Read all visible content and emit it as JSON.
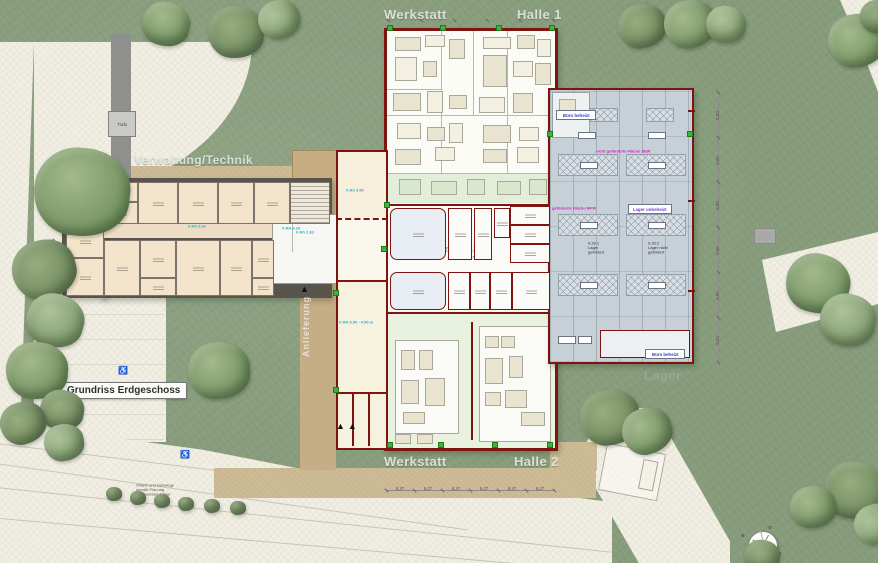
{
  "plan": {
    "title_box": "Grundriss Erdgeschoss",
    "zones": {
      "werkstatt_top": "Werkstatt",
      "halle_1": "Halle 1",
      "werkstatt_bottom": "Werkstatt",
      "halle_2": "Halle 2",
      "verwaltung": "Verwaltung/Technik",
      "sozialtrakt": "Sozialtrakt",
      "lager": "Lager",
      "anlieferung": "Anlieferung"
    },
    "funding_labels": {
      "nicht_gefoerdert": "nicht geförderte Fläche SEW",
      "gefoerdert": "geförderte Fläche MFW",
      "lager_unbeheizt": "Lager unbeheizt",
      "buero_beheizt_1": "Büro beheizt",
      "buero_beheizt_2": "Büro beheizt"
    },
    "room_notes": {
      "lager_gefoerdert": "0.28.1\nLager gefördert",
      "lager_nicht_gefoerdert": "0.28.2\nLager nicht gefördert"
    },
    "height_notes": {
      "admin_corridor": "h Rh 2.63",
      "admin_right": "h Rh 2.63",
      "bhkw": "h Rh 3.50",
      "silo": "h RH 3.50 - 4.50 m",
      "sozial_1": "h RW 2.50",
      "sozial_2": "h RW 2.50",
      "foyer": "h RH 4.26"
    },
    "misc": {
      "trafo": "Trafo",
      "road_note": "Straße und Gehwege\ngemäß Planung\nkommunaler Träger"
    },
    "compass": {
      "n": "N",
      "e": "O",
      "s": "S",
      "w": "W"
    },
    "dimensions": {
      "bottom": [
        "6,27",
        "6,27",
        "6,27",
        "6,27",
        "6,27",
        "6,27"
      ],
      "right": [
        "5,00",
        "5,00",
        "5,00",
        "5,00",
        "5,00",
        "5,00"
      ]
    },
    "colors": {
      "grass": "#879c7b",
      "paving": "#f1eee3",
      "beige": "#cdbb96",
      "tan_strip": "#c5ad85",
      "wall_red": "#7e1410",
      "wall_gray": "#59544c",
      "admin_room": "#f3e3ca",
      "hall_gray": "#c7d0d7",
      "halle2_green": "#e9f2df",
      "cream": "#f6f0da",
      "magenta": "#d024c4",
      "blue": "#2b3fc9",
      "purple": "#6c3fd4",
      "cyan": "#1ab3d8",
      "door_green": "#3db53d"
    }
  }
}
